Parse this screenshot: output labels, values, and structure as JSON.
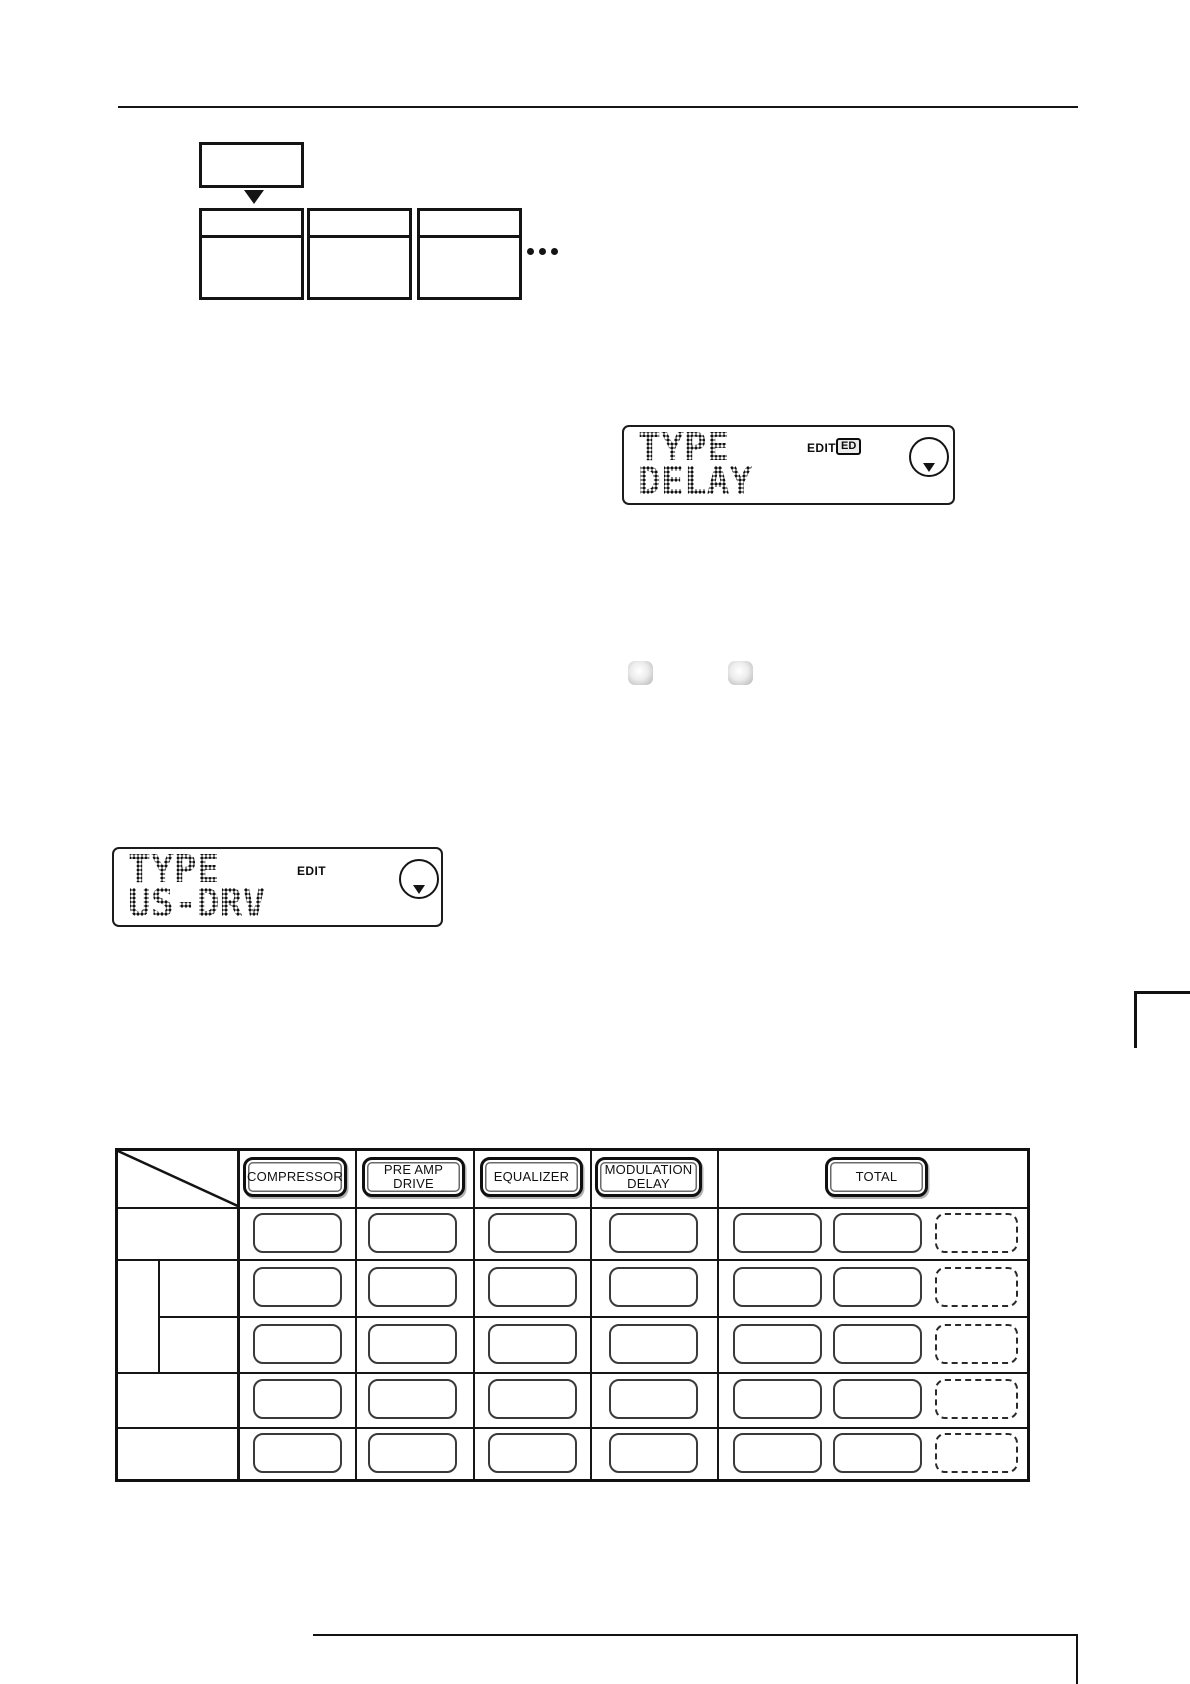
{
  "lcd1": {
    "line1": "TYPE",
    "line2": "DELAY",
    "edit_label": "EDIT",
    "edit_badge": "ED"
  },
  "lcd2": {
    "line1": "TYPE",
    "line2": "US-DRV",
    "edit_label": "EDIT"
  },
  "table": {
    "header": {
      "compressor": "COMPRESSOR",
      "preamp_line1": "PRE AMP",
      "preamp_line2": "DRIVE",
      "equalizer": "EQUALIZER",
      "modulation_line1": "MODULATION",
      "modulation_line2": "DELAY",
      "total": "TOTAL"
    },
    "row_count": 5
  },
  "colors": {
    "ink": "#111111",
    "write_box_border": "#3a3a3a",
    "button_gray": "#c4c4c4"
  }
}
